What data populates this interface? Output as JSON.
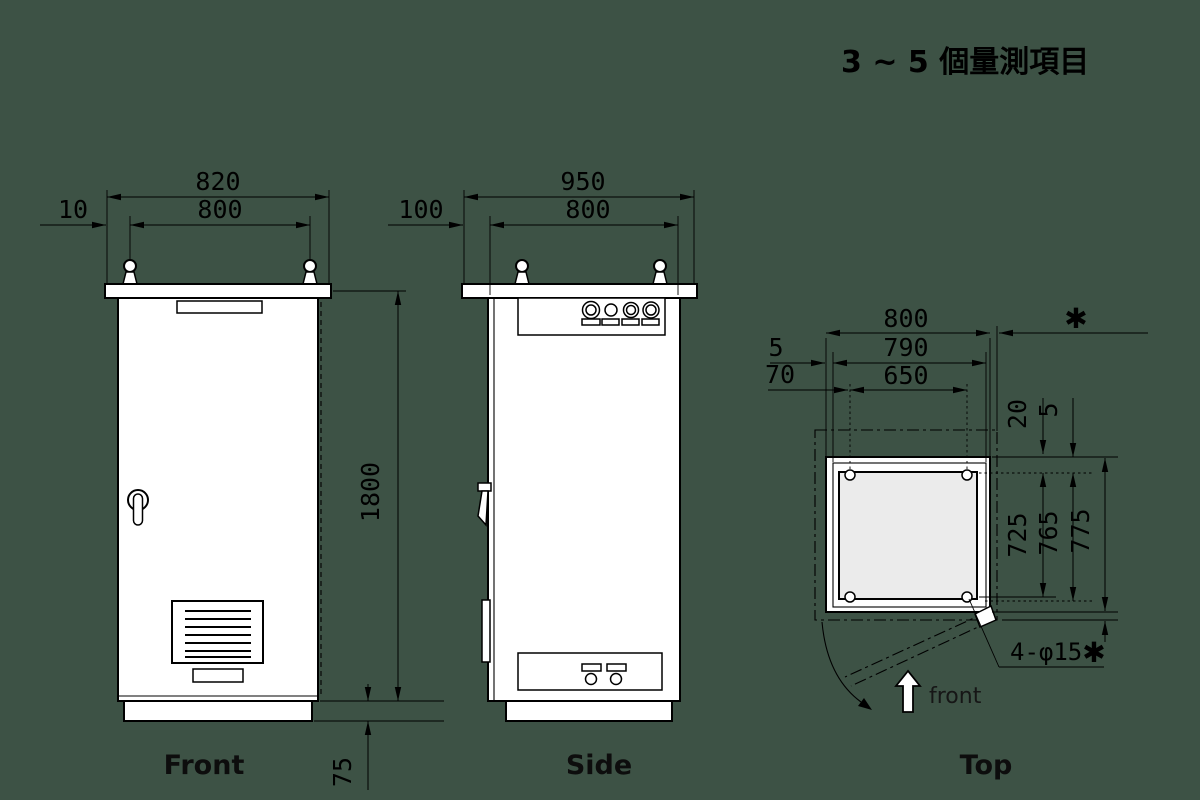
{
  "title": "3 ~ 5 個量測項目",
  "views": {
    "front": {
      "label": "Front",
      "dims": {
        "plate_width": "820",
        "body_width": "800",
        "edge_offset": "10",
        "body_height": "1800",
        "base_height": "75"
      }
    },
    "side": {
      "label": "Side",
      "dims": {
        "plate_depth": "950",
        "body_depth": "800",
        "front_offset": "100"
      }
    },
    "top": {
      "label": "Top",
      "front_marker": "front",
      "dims": {
        "body_width": "800",
        "door_width": "790",
        "plate_width": "650",
        "gap_left": "5",
        "hole_offset": "70",
        "rear_gap": "20",
        "rear_plate_gap": "5",
        "hole_span": "725",
        "plate_depth": "765",
        "body_depth": "775"
      },
      "hole_note": "4-φ15",
      "asterisk": "✱"
    }
  },
  "colors": {
    "background": "#3d5245",
    "line": "#000000",
    "fill": "#ffffff",
    "plate_fill": "#ebebeb"
  }
}
